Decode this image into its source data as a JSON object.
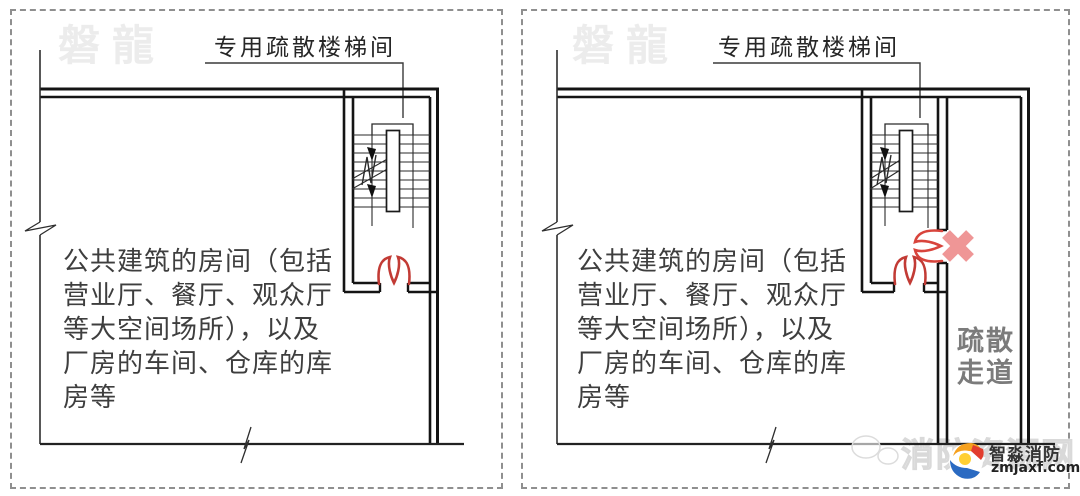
{
  "panels": [
    {
      "watermark": "磐龍",
      "stair_label": "专用疏散楼梯间",
      "room_text": "公共建筑的房间（包括\n营业厅、餐厅、观众厅\n等大空间场所），以及\n厂房的车间、仓库的库\n房等"
    },
    {
      "watermark": "磐龍",
      "stair_label": "专用疏散楼梯间",
      "room_text": "公共建筑的房间（包括\n营业厅、餐厅、观众厅\n等大空间场所），以及\n厂房的车间、仓库的库\n房等",
      "corridor_label": "疏散\n走道"
    }
  ],
  "footer_brand": {
    "watermark_text": "消防资源网",
    "brand_name": "智淼消防",
    "brand_url": "zmjaxf.com"
  },
  "colors": {
    "door_red": "#c23b35",
    "cross_pink": "#ef9696",
    "wall_black": "#161616",
    "corridor_text_gray": "#7b7b7b",
    "watermark_gray": "#ececec"
  }
}
